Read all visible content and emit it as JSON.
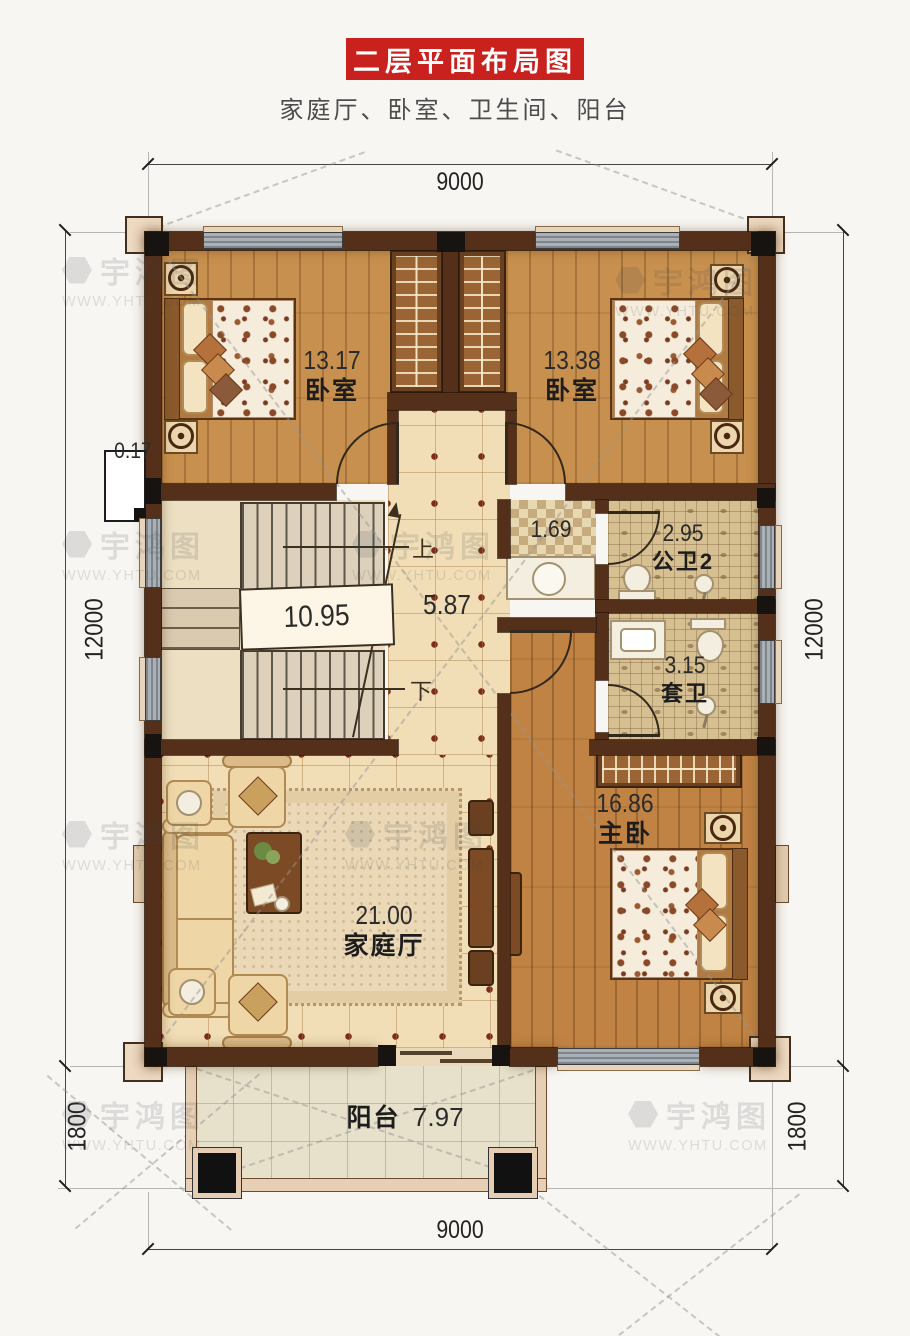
{
  "header": {
    "title": "二层平面布局图",
    "subtitle": "家庭厅、卧室、卫生间、阳台"
  },
  "dimensions": {
    "top": "9000",
    "bottom": "9000",
    "left": "12000",
    "right": "12000",
    "balcony_left": "1800",
    "balcony_right": "1800"
  },
  "rooms": {
    "bedroom_left": {
      "area": "13.17",
      "name": "卧室"
    },
    "bedroom_right": {
      "area": "13.38",
      "name": "卧室"
    },
    "stairwell": {
      "area": "10.95"
    },
    "corridor": {
      "area": "5.87"
    },
    "washroom_nook": {
      "area": "1.69"
    },
    "public_bath": {
      "area": "2.95",
      "name": "公卫2"
    },
    "ensuite_bath": {
      "area": "3.15",
      "name": "套卫"
    },
    "master_bedroom": {
      "area": "16.86",
      "name": "主卧"
    },
    "family_hall": {
      "area": "21.00",
      "name": "家庭厅"
    },
    "balcony": {
      "name": "阳台",
      "area": "7.97"
    },
    "wall_niche": {
      "area": "0.17"
    }
  },
  "stairs": {
    "up": "上",
    "down": "下"
  },
  "watermark": {
    "name": "宇鸿图",
    "url": "WWW.YHTU.COM"
  },
  "colors": {
    "accent_red": "#c9211e",
    "wall_brown": "#54301b",
    "wood": "#c8904e",
    "tile": "#f1deb6"
  }
}
